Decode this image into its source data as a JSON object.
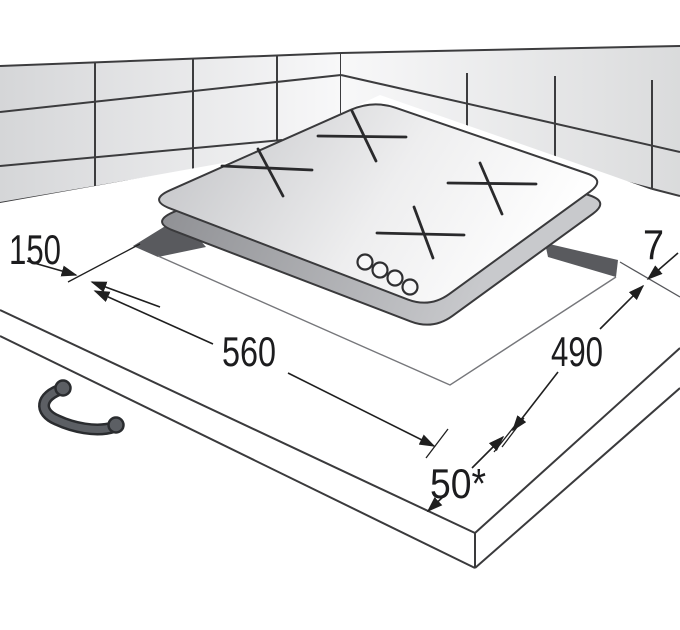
{
  "diagram": {
    "subject": "built-in cooktop installation cutout drawing",
    "dimensions": {
      "wall_side_clearance": "150",
      "cutout_width": "560",
      "cutout_depth": "490",
      "front_edge_clearance": "50*",
      "right_clearance": "7"
    },
    "features": {
      "burner_marks": 4,
      "control_knobs": 4
    },
    "colors": {
      "line": "#1f1f1f",
      "tile_grout": "#3c3c3e",
      "cutout_fill": "#595a5e",
      "glass_dark": "#c6c7ca",
      "glass_light": "#ffffff",
      "handle": "#5c5f64"
    }
  }
}
